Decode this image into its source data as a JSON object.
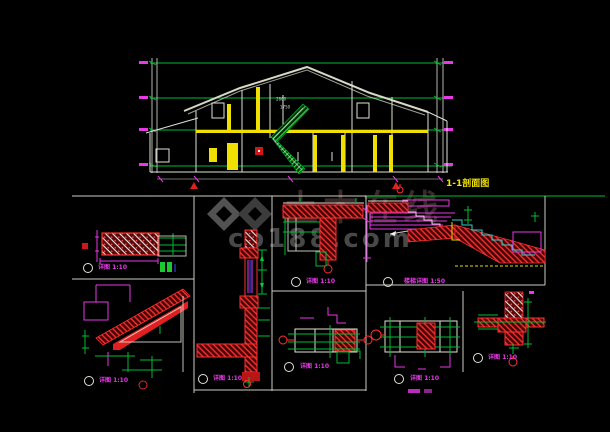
{
  "title": {
    "section_label": "1-1剖面图"
  },
  "watermark": {
    "cn_text": "土木在线",
    "domain_text": "co188.com",
    "logo_text": "CO"
  },
  "section": {
    "stair_note_top": "2800",
    "stair_note_bottom": "1750"
  },
  "details": [
    {
      "name": "skirting-detail",
      "label": "详图 1:10"
    },
    {
      "name": "eave-detail",
      "label": "详图 1:10"
    },
    {
      "name": "wall-section-detail",
      "label": "详图 1:10"
    },
    {
      "name": "slab-column-detail",
      "label": "详图 1:10"
    },
    {
      "name": "stair-detail",
      "label": "楼梯详图 1:50"
    },
    {
      "name": "beam-detail-a",
      "label": "详图 1:10"
    },
    {
      "name": "beam-detail-b",
      "label": "详图 1:10"
    },
    {
      "name": "wall-joint-detail",
      "label": "详图 1:10"
    }
  ],
  "colors": {
    "background": "#000000",
    "line_green": "#00bb33",
    "line_magenta": "#e838e8",
    "line_red": "#ff3030",
    "line_yellow": "#f0e000",
    "line_white": "#e8e8e8",
    "line_cyan": "#30d0d0",
    "watermark_gray": "#4c4c4c"
  }
}
